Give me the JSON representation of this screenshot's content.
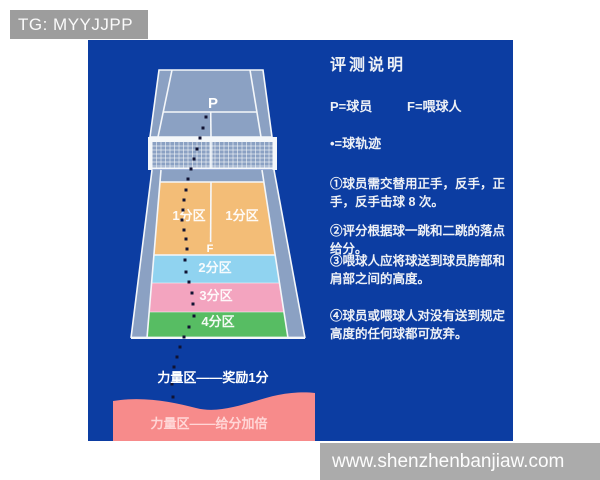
{
  "header": {
    "tag_label": "TG: MYYJJPP"
  },
  "panel": {
    "bg": "#0c3da2"
  },
  "court": {
    "court_color": "#8ba1c3",
    "line_color": "#f4f7fa",
    "player_label": "P",
    "feeder_label": "F",
    "zones": [
      {
        "id": "zone-1-left",
        "label": "1分区",
        "color": "#f3bd77"
      },
      {
        "id": "zone-1-right",
        "label": "1分区",
        "color": "#f3bd77"
      },
      {
        "id": "zone-2",
        "label": "2分区",
        "color": "#90d3f0"
      },
      {
        "id": "zone-3",
        "label": "3分区",
        "color": "#f3a4bf"
      },
      {
        "id": "zone-4",
        "label": "4分区",
        "color": "#57bd63"
      }
    ],
    "dot_color": "#101232",
    "trajectory_dots": [
      [
        118,
        77
      ],
      [
        115,
        88
      ],
      [
        112,
        98
      ],
      [
        109,
        109
      ],
      [
        106,
        119
      ],
      [
        103,
        129
      ],
      [
        100,
        139
      ],
      [
        98,
        150
      ],
      [
        96,
        160
      ],
      [
        95,
        170
      ],
      [
        94,
        180
      ],
      [
        96,
        190
      ],
      [
        98,
        199
      ],
      [
        99,
        209
      ],
      [
        97,
        220
      ],
      [
        98,
        232
      ],
      [
        101,
        242
      ],
      [
        104,
        253
      ],
      [
        105,
        264
      ],
      [
        106,
        276
      ],
      [
        101,
        287
      ],
      [
        96,
        297
      ],
      [
        92,
        307
      ],
      [
        89,
        317
      ],
      [
        86,
        327
      ],
      [
        84,
        344
      ],
      [
        85,
        357
      ],
      [
        87,
        367
      ]
    ]
  },
  "power_zones": {
    "bonus_label": "力量区——奖励1分",
    "double_label": "力量区——给分加倍",
    "double_bg": "#f78b8b",
    "double_text_color": "#ffd6d6"
  },
  "legend_panel": {
    "title": "评测说明",
    "player_def": "P=球员",
    "feeder_def": "F=喂球人",
    "trajectory_def": "•=球轨迹",
    "rules": [
      "①球员需交替用正手，反手，正手，反手击球 8 次。",
      "②评分根据球一跳和二跳的落点给分。",
      "③喂球人应将球送到球员胯部和肩部之间的高度。",
      "④球员或喂球人对没有送到规定高度的任何球都可放弃。"
    ]
  },
  "footer": {
    "watermark": "www.shenzhenbanjiaw.com"
  }
}
